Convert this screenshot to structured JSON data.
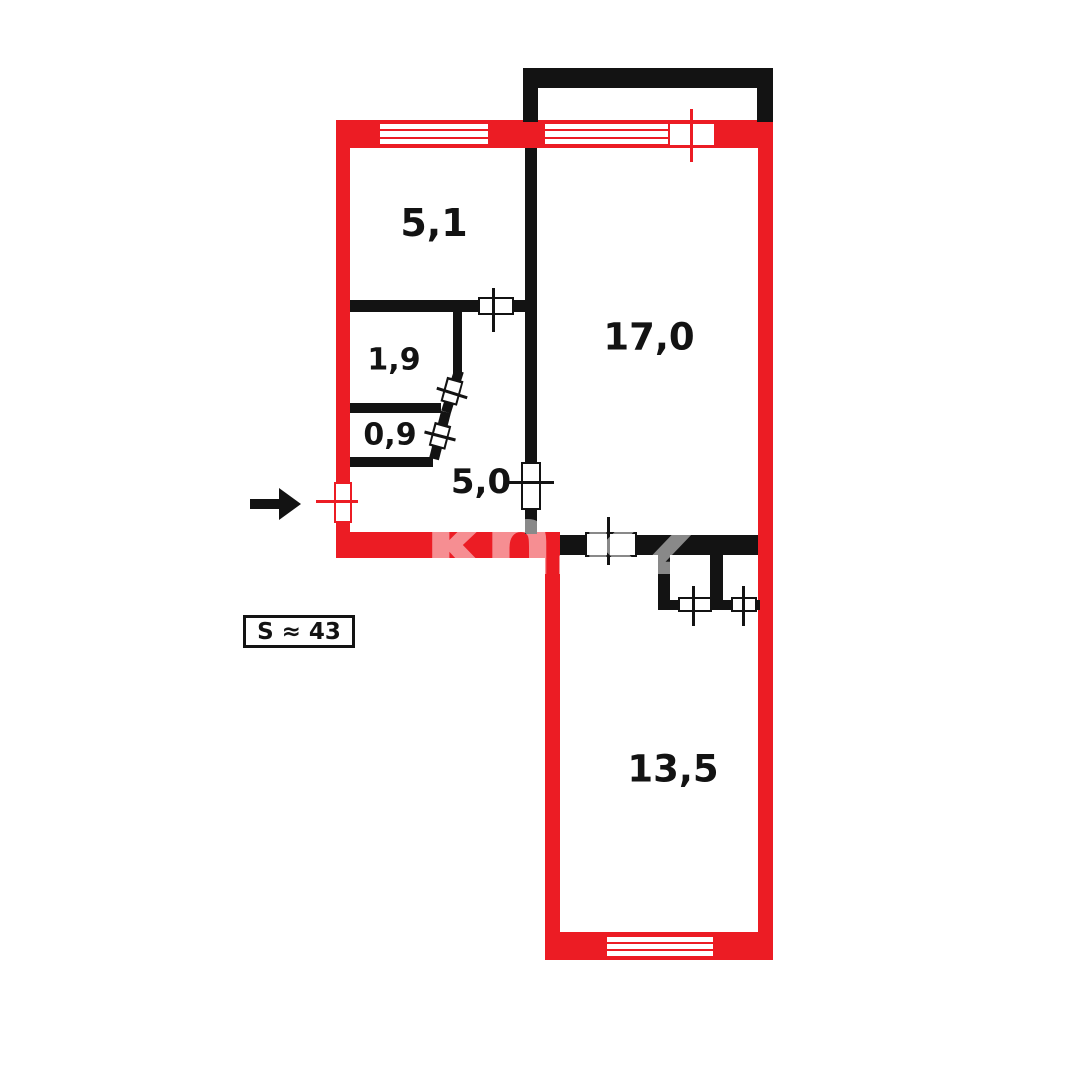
{
  "plan": {
    "room_labels": [
      {
        "id": "room-5-1",
        "label": "5,1"
      },
      {
        "id": "room-1-9",
        "label": "1,9"
      },
      {
        "id": "room-0-9",
        "label": "0,9"
      },
      {
        "id": "room-5-0",
        "label": "5,0"
      },
      {
        "id": "room-17-0",
        "label": "17,0"
      },
      {
        "id": "room-13-5",
        "label": "13,5"
      }
    ],
    "total_area_label": "S ≈ 43",
    "watermark_text": "kn.kz",
    "colors": {
      "exterior_wall_red": "#ec1c24",
      "interior_wall_black": "#131313"
    },
    "icons": {
      "entrance_arrow": "black-right-arrow"
    }
  }
}
